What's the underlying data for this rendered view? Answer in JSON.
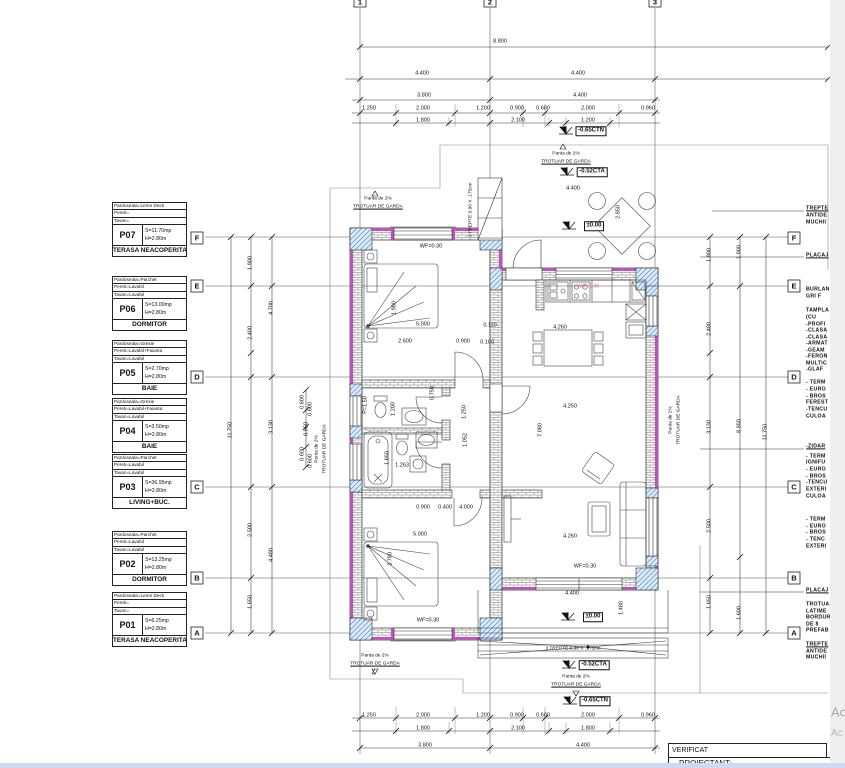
{
  "legend": {
    "rooms": [
      {
        "code": "P07",
        "rows": [
          "Pardoseala=Lemn Deck",
          "Pereti=",
          "Tavan="
        ],
        "area": "S=11.70mp",
        "height": "H=2.80m",
        "name": "TERASA NEACOPERITA"
      },
      {
        "code": "P06",
        "rows": [
          "Pardoseala=Parchet",
          "Pereti=Lavabil",
          "Tavan=Lavabil"
        ],
        "area": "S=13.00mp",
        "height": "H=2.80m",
        "name": "DORMITOR"
      },
      {
        "code": "P05",
        "rows": [
          "Pardoseala=Gresie",
          "Pereti=Lavabil+Faianta",
          "Tavan=Lavabil"
        ],
        "area": "S=2.70mp",
        "height": "H=2.80m",
        "name": "BAIE"
      },
      {
        "code": "P04",
        "rows": [
          "Pardoseala=Gresie",
          "Pereti=Lavabil+Faianta",
          "Tavan=Lavabil"
        ],
        "area": "S=3.50mp",
        "height": "H=2.80m",
        "name": "BAIE"
      },
      {
        "code": "P03",
        "rows": [
          "Pardoseala=Parchet",
          "Pereti=Lavabil",
          "Tavan=Lavabil"
        ],
        "area": "S=36.95mp",
        "height": "H=2.80m",
        "name": "LIVING+BUC."
      },
      {
        "code": "P02",
        "rows": [
          "Pardoseala=Parchet",
          "Pereti=Lavabil",
          "Tavan=Lavabil"
        ],
        "area": "S=13.25mp",
        "height": "H=2.80m",
        "name": "DORMITOR"
      },
      {
        "code": "P01",
        "rows": [
          "Pardoseala=Lemn Deck",
          "Pereti=",
          "Tavan="
        ],
        "area": "S=6.25mp",
        "height": "H=2.80m",
        "name": "TERASA NEACOPERITA"
      }
    ]
  },
  "grid": {
    "columns": [
      "1",
      "2",
      "3"
    ],
    "rows": [
      "F",
      "E",
      "D",
      "C",
      "B",
      "A"
    ]
  },
  "titleblock": {
    "verificat": "VERIFICAT",
    "proiectant": "PROIECTANT:"
  },
  "colors": {
    "wall_insulation": "#bb55bb",
    "concrete_hatch": "#4f93cf",
    "red_label": "#dd7777"
  },
  "annotations": [
    {
      "x": 360,
      "y": 2,
      "t": "1",
      "c": "num",
      "n": "grid-col-1"
    },
    {
      "x": 490,
      "y": 2,
      "t": "2",
      "c": "num",
      "n": "grid-col-2"
    },
    {
      "x": 655,
      "y": 2,
      "t": "3",
      "c": "num",
      "n": "grid-col-3"
    },
    {
      "x": 197,
      "y": 238,
      "t": "F",
      "c": "num",
      "n": "grid-row-f-left"
    },
    {
      "x": 197,
      "y": 286,
      "t": "E",
      "c": "num",
      "n": "grid-row-e-left"
    },
    {
      "x": 197,
      "y": 377,
      "t": "D",
      "c": "num",
      "n": "grid-row-d-left"
    },
    {
      "x": 197,
      "y": 487,
      "t": "C",
      "c": "num",
      "n": "grid-row-c-left"
    },
    {
      "x": 197,
      "y": 578,
      "t": "B",
      "c": "num",
      "n": "grid-row-b-left"
    },
    {
      "x": 197,
      "y": 633,
      "t": "A",
      "c": "num",
      "n": "grid-row-a-left"
    },
    {
      "x": 794,
      "y": 238,
      "t": "F",
      "c": "num",
      "n": "grid-row-f-right"
    },
    {
      "x": 794,
      "y": 286,
      "t": "E",
      "c": "num",
      "n": "grid-row-e-right"
    },
    {
      "x": 794,
      "y": 377,
      "t": "D",
      "c": "num",
      "n": "grid-row-d-right"
    },
    {
      "x": 794,
      "y": 487,
      "t": "C",
      "c": "num",
      "n": "grid-row-c-right"
    },
    {
      "x": 794,
      "y": 578,
      "t": "B",
      "c": "num",
      "n": "grid-row-b-right"
    },
    {
      "x": 794,
      "y": 633,
      "t": "A",
      "c": "num",
      "n": "grid-row-a-right"
    },
    {
      "x": 500,
      "y": 42,
      "t": "8.800",
      "c": "d"
    },
    {
      "x": 422,
      "y": 74,
      "t": "4.400",
      "c": "d"
    },
    {
      "x": 578,
      "y": 74,
      "t": "4.400",
      "c": "d"
    },
    {
      "x": 424,
      "y": 96,
      "t": "3.800",
      "c": "d"
    },
    {
      "x": 580,
      "y": 96,
      "t": "4.400",
      "c": "d"
    },
    {
      "x": 369,
      "y": 109,
      "t": "1.250",
      "c": "d"
    },
    {
      "x": 423,
      "y": 109,
      "t": "2.000",
      "c": "d"
    },
    {
      "x": 483,
      "y": 109,
      "t": "1.200",
      "c": "d"
    },
    {
      "x": 517,
      "y": 109,
      "t": "0.900",
      "c": "d"
    },
    {
      "x": 543,
      "y": 109,
      "t": "0.600",
      "c": "d"
    },
    {
      "x": 588,
      "y": 109,
      "t": "2.000",
      "c": "d"
    },
    {
      "x": 648,
      "y": 109,
      "t": "0.960",
      "c": "d"
    },
    {
      "x": 423,
      "y": 121,
      "t": "1.800",
      "c": "d"
    },
    {
      "x": 518,
      "y": 121,
      "t": "2.100",
      "c": "d"
    },
    {
      "x": 588,
      "y": 121,
      "t": "1.200",
      "c": "d"
    },
    {
      "x": 369,
      "y": 716,
      "t": "1.250",
      "c": "d"
    },
    {
      "x": 423,
      "y": 716,
      "t": "2.000",
      "c": "d"
    },
    {
      "x": 483,
      "y": 716,
      "t": "1.200",
      "c": "d"
    },
    {
      "x": 517,
      "y": 716,
      "t": "0.900",
      "c": "d"
    },
    {
      "x": 543,
      "y": 716,
      "t": "0.600",
      "c": "d"
    },
    {
      "x": 588,
      "y": 716,
      "t": "2.000",
      "c": "d"
    },
    {
      "x": 648,
      "y": 716,
      "t": "0.960",
      "c": "d"
    },
    {
      "x": 423,
      "y": 729,
      "t": "1.800",
      "c": "d"
    },
    {
      "x": 518,
      "y": 729,
      "t": "2.100",
      "c": "d"
    },
    {
      "x": 588,
      "y": 729,
      "t": "1.800",
      "c": "d"
    },
    {
      "x": 425,
      "y": 746,
      "t": "3.800",
      "c": "d"
    },
    {
      "x": 583,
      "y": 746,
      "t": "4.400",
      "c": "d"
    },
    {
      "x": 231,
      "y": 430,
      "t": "11.750",
      "c": "v"
    },
    {
      "x": 251,
      "y": 263,
      "t": "1.900",
      "c": "v"
    },
    {
      "x": 251,
      "y": 333,
      "t": "2.400",
      "c": "v"
    },
    {
      "x": 251,
      "y": 530,
      "t": "2.500",
      "c": "v"
    },
    {
      "x": 251,
      "y": 602,
      "t": "1.650",
      "c": "v"
    },
    {
      "x": 272,
      "y": 308,
      "t": "4.700",
      "c": "v"
    },
    {
      "x": 272,
      "y": 427,
      "t": "3.130",
      "c": "v"
    },
    {
      "x": 272,
      "y": 555,
      "t": "4.480",
      "c": "v"
    },
    {
      "x": 303,
      "y": 402,
      "t": "0.600",
      "c": "v"
    },
    {
      "x": 311,
      "y": 409,
      "t": "0.600",
      "c": "v"
    },
    {
      "x": 307,
      "y": 429,
      "t": "0.950",
      "c": "v"
    },
    {
      "x": 303,
      "y": 454,
      "t": "0.600",
      "c": "v"
    },
    {
      "x": 311,
      "y": 461,
      "t": "0.600",
      "c": "v"
    },
    {
      "x": 710,
      "y": 255,
      "t": "1.900",
      "c": "v"
    },
    {
      "x": 710,
      "y": 329,
      "t": "2.400",
      "c": "v"
    },
    {
      "x": 710,
      "y": 427,
      "t": "3.130",
      "c": "v"
    },
    {
      "x": 710,
      "y": 526,
      "t": "2.500",
      "c": "v"
    },
    {
      "x": 710,
      "y": 602,
      "t": "1.650",
      "c": "v"
    },
    {
      "x": 740,
      "y": 252,
      "t": "1.900",
      "c": "v"
    },
    {
      "x": 740,
      "y": 426,
      "t": "8.850",
      "c": "v"
    },
    {
      "x": 740,
      "y": 613,
      "t": "1.600",
      "c": "v"
    },
    {
      "x": 766,
      "y": 432,
      "t": "11.750",
      "c": "v"
    },
    {
      "x": 591,
      "y": 131,
      "t": "-0.65CTN",
      "c": "b",
      "n": "level-ctn-top"
    },
    {
      "x": 592,
      "y": 172,
      "t": "-0.52CTA",
      "c": "b",
      "n": "level-cta-top"
    },
    {
      "x": 594,
      "y": 226,
      "t": "±0.00",
      "c": "b",
      "n": "level-zero-terrace"
    },
    {
      "x": 593,
      "y": 617,
      "t": "±0.00",
      "c": "b",
      "n": "level-zero-bottom"
    },
    {
      "x": 594,
      "y": 665,
      "t": "-0.52CTA",
      "c": "b",
      "n": "level-cta-bottom"
    },
    {
      "x": 595,
      "y": 701,
      "t": "-0.65CTN",
      "c": "b",
      "n": "level-ctn-bottom"
    },
    {
      "x": 378,
      "y": 200,
      "t": "Panta de 2%",
      "c": "s",
      "n": "slope-label"
    },
    {
      "x": 378,
      "y": 208,
      "t": "TROTUAR DE GARDA",
      "c": "su",
      "n": "trotuar-label"
    },
    {
      "x": 566,
      "y": 155,
      "t": "Panta de 2%",
      "c": "s",
      "n": "slope-label"
    },
    {
      "x": 566,
      "y": 163,
      "t": "TROTUAR DE GARDA",
      "c": "su",
      "n": "trotuar-label"
    },
    {
      "x": 375,
      "y": 657,
      "t": "Panta de 2%",
      "c": "s",
      "n": "slope-label"
    },
    {
      "x": 375,
      "y": 665,
      "t": "TROTUAR DE GARDA",
      "c": "su",
      "n": "trotuar-label"
    },
    {
      "x": 576,
      "y": 678,
      "t": "Panta de 2%",
      "c": "s",
      "n": "slope-label"
    },
    {
      "x": 576,
      "y": 686,
      "t": "TROTUAR DE GARDA",
      "c": "su",
      "n": "trotuar-label"
    },
    {
      "x": 318,
      "y": 449,
      "t": "Panta de 2%",
      "c": "sv",
      "n": "slope-label"
    },
    {
      "x": 326,
      "y": 449,
      "t": "TROTUAR DE GARDA",
      "c": "sv",
      "n": "trotuar-label"
    },
    {
      "x": 672,
      "y": 420,
      "t": "Panta de 2%",
      "c": "sv",
      "n": "slope-label"
    },
    {
      "x": 680,
      "y": 420,
      "t": "TROTUAR DE GARDA",
      "c": "sv",
      "n": "trotuar-label"
    },
    {
      "x": 472,
      "y": 210,
      "t": "3 TREPTE 0.90 X .175cm",
      "c": "sv",
      "n": "stairs-note-top"
    },
    {
      "x": 573,
      "y": 650,
      "t": "3 TREPTE 0.30 X .175cm",
      "c": "s",
      "n": "stairs-note-bottom"
    },
    {
      "x": 431,
      "y": 247,
      "t": "WF=0.30",
      "c": "d",
      "n": "window-sill-label"
    },
    {
      "x": 428,
      "y": 621,
      "t": "WF=0.30",
      "c": "d",
      "n": "window-sill-label"
    },
    {
      "x": 585,
      "y": 567,
      "t": "WF=0.30",
      "c": "d",
      "n": "window-sill-label"
    },
    {
      "x": 589,
      "y": 287,
      "t": "WF=0.90",
      "c": "red",
      "n": "window-sill-label"
    },
    {
      "x": 366,
      "y": 405,
      "t": "P=1.50",
      "c": "v",
      "n": "parapet-label"
    },
    {
      "x": 573,
      "y": 189,
      "t": "4.400",
      "c": "d"
    },
    {
      "x": 619,
      "y": 212,
      "t": "2.850",
      "c": "v"
    },
    {
      "x": 572,
      "y": 594,
      "t": "4.400",
      "c": "d"
    },
    {
      "x": 622,
      "y": 608,
      "t": "1.480",
      "c": "v"
    },
    {
      "x": 395,
      "y": 308,
      "t": "1.900",
      "c": "v"
    },
    {
      "x": 423,
      "y": 325,
      "t": "5.000",
      "c": "d"
    },
    {
      "x": 490,
      "y": 326,
      "t": "0.110",
      "c": "d"
    },
    {
      "x": 405,
      "y": 342,
      "t": "2.600",
      "c": "d"
    },
    {
      "x": 463,
      "y": 342,
      "t": "0.900",
      "c": "d"
    },
    {
      "x": 487,
      "y": 343,
      "t": "0.100",
      "c": "d"
    },
    {
      "x": 394,
      "y": 409,
      "t": "1.200",
      "c": "v"
    },
    {
      "x": 465,
      "y": 412,
      "t": "1.250",
      "c": "v"
    },
    {
      "x": 433,
      "y": 393,
      "t": "0.750",
      "c": "v"
    },
    {
      "x": 466,
      "y": 440,
      "t": "1.052",
      "c": "v"
    },
    {
      "x": 388,
      "y": 458,
      "t": "1.650",
      "c": "v"
    },
    {
      "x": 402,
      "y": 466,
      "t": "1.263",
      "c": "d"
    },
    {
      "x": 423,
      "y": 508,
      "t": "0.900",
      "c": "d"
    },
    {
      "x": 445,
      "y": 508,
      "t": "0.400",
      "c": "d"
    },
    {
      "x": 466,
      "y": 508,
      "t": "4.000",
      "c": "d"
    },
    {
      "x": 560,
      "y": 328,
      "t": "4.260",
      "c": "d"
    },
    {
      "x": 570,
      "y": 407,
      "t": "4.250",
      "c": "d"
    },
    {
      "x": 541,
      "y": 430,
      "t": "7.080",
      "c": "v"
    },
    {
      "x": 570,
      "y": 537,
      "t": "4.260",
      "c": "d"
    },
    {
      "x": 420,
      "y": 535,
      "t": "5.000",
      "c": "d"
    },
    {
      "x": 391,
      "y": 559,
      "t": "3.780",
      "c": "v"
    },
    {
      "x": 806,
      "y": 209,
      "t": "TREPTE",
      "c": "fu"
    },
    {
      "x": 806,
      "y": 216,
      "t": "ANTIDE",
      "c": "f"
    },
    {
      "x": 806,
      "y": 223,
      "t": "MUCHII",
      "c": "f"
    },
    {
      "x": 806,
      "y": 256,
      "t": "PLACAJ",
      "c": "fu"
    },
    {
      "x": 806,
      "y": 290,
      "t": "BURLAN",
      "c": "f"
    },
    {
      "x": 806,
      "y": 297,
      "t": "GRI F",
      "c": "f"
    },
    {
      "x": 806,
      "y": 311,
      "t": "TAMPLA",
      "c": "f"
    },
    {
      "x": 806,
      "y": 318,
      "t": "(CU",
      "c": "f"
    },
    {
      "x": 806,
      "y": 325,
      "t": "-PROFI",
      "c": "f"
    },
    {
      "x": 806,
      "y": 331,
      "t": "-CLASA",
      "c": "f"
    },
    {
      "x": 806,
      "y": 338,
      "t": "-CLASA",
      "c": "f"
    },
    {
      "x": 806,
      "y": 344,
      "t": "-ARMAT",
      "c": "f"
    },
    {
      "x": 806,
      "y": 351,
      "t": "-GEAM",
      "c": "f"
    },
    {
      "x": 806,
      "y": 357,
      "t": "-FERON",
      "c": "f"
    },
    {
      "x": 806,
      "y": 364,
      "t": "MULTIC",
      "c": "f"
    },
    {
      "x": 806,
      "y": 370,
      "t": "-GLAF",
      "c": "f"
    },
    {
      "x": 806,
      "y": 383,
      "t": "- TERM",
      "c": "f"
    },
    {
      "x": 806,
      "y": 390,
      "t": "- EURO",
      "c": "f"
    },
    {
      "x": 806,
      "y": 397,
      "t": "- BROS",
      "c": "f"
    },
    {
      "x": 806,
      "y": 403,
      "t": "FEREST",
      "c": "f"
    },
    {
      "x": 806,
      "y": 410,
      "t": "-TENCU",
      "c": "f"
    },
    {
      "x": 806,
      "y": 417,
      "t": "CULOA",
      "c": "f"
    },
    {
      "x": 806,
      "y": 447,
      "t": "-ZIDAR",
      "c": "fu"
    },
    {
      "x": 806,
      "y": 457,
      "t": "- TERM",
      "c": "f"
    },
    {
      "x": 806,
      "y": 463,
      "t": "IGNIFU",
      "c": "f"
    },
    {
      "x": 806,
      "y": 470,
      "t": "- EURO",
      "c": "f"
    },
    {
      "x": 806,
      "y": 477,
      "t": "- BROS",
      "c": "f"
    },
    {
      "x": 806,
      "y": 483,
      "t": "-TENCU",
      "c": "f"
    },
    {
      "x": 806,
      "y": 490,
      "t": "EXTERI",
      "c": "f"
    },
    {
      "x": 806,
      "y": 497,
      "t": "CULOA",
      "c": "f"
    },
    {
      "x": 806,
      "y": 520,
      "t": "- TERM",
      "c": "f"
    },
    {
      "x": 806,
      "y": 527,
      "t": "- EURO",
      "c": "f"
    },
    {
      "x": 806,
      "y": 533,
      "t": "- BROS",
      "c": "f"
    },
    {
      "x": 806,
      "y": 540,
      "t": "- TENC",
      "c": "f"
    },
    {
      "x": 806,
      "y": 547,
      "t": "EXTERI",
      "c": "f"
    },
    {
      "x": 806,
      "y": 591,
      "t": "PLACAJ",
      "c": "fu"
    },
    {
      "x": 806,
      "y": 605,
      "t": "TROTUA",
      "c": "f"
    },
    {
      "x": 806,
      "y": 612,
      "t": "LATIME",
      "c": "f"
    },
    {
      "x": 806,
      "y": 618,
      "t": "BORDUR",
      "c": "f"
    },
    {
      "x": 806,
      "y": 625,
      "t": "DE 8",
      "c": "f"
    },
    {
      "x": 806,
      "y": 631,
      "t": "PREFAB",
      "c": "f"
    },
    {
      "x": 806,
      "y": 645,
      "t": "TREPTE",
      "c": "fu"
    },
    {
      "x": 806,
      "y": 652,
      "t": "ANTIDE",
      "c": "f"
    },
    {
      "x": 806,
      "y": 658,
      "t": "MUCHII",
      "c": "f"
    },
    {
      "x": 831,
      "y": 712,
      "t": "Ac",
      "c": "g1",
      "n": "watermark"
    },
    {
      "x": 831,
      "y": 734,
      "t": "Ac",
      "c": "g2",
      "n": "watermark"
    }
  ]
}
